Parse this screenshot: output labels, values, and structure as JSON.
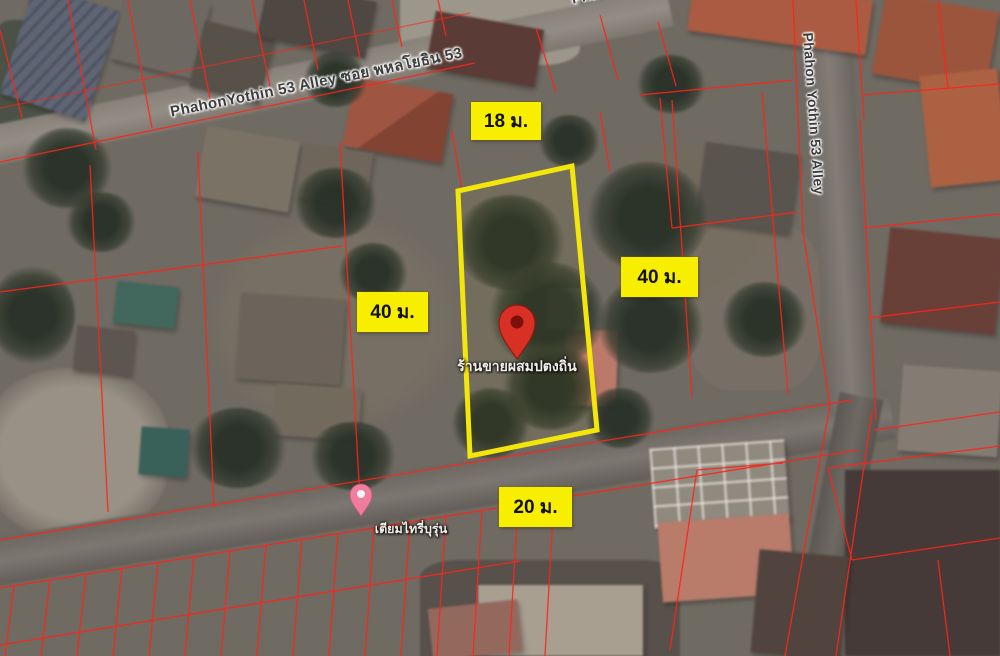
{
  "map": {
    "view": "satellite",
    "roads": {
      "top_alley_label": "PhahonYothin 53 Alley ซอย พหลโยธิน 53",
      "right_alley_label": "Phahon Yothin 53 Alley",
      "top_edge_partial_label": "Phahon"
    },
    "plot": {
      "outline_color": "#f2e60a",
      "dimensions": {
        "top": "18 ม.",
        "left": "40 ม.",
        "right": "40 ม.",
        "bottom": "20 ม."
      }
    },
    "markers": {
      "main_pin": {
        "icon": "red-location-pin",
        "color": "#d93025",
        "label": "ร้านขายผสมปตงถิ่น"
      },
      "poi_pin": {
        "icon": "pink-place-pin",
        "color": "#ee7d9e",
        "label": "เตียมไทรี่บุรุ่น"
      }
    },
    "overlay_colors": {
      "cadastral_line": "#ff2419",
      "dimension_label_bg": "#f8ee00",
      "dimension_label_text": "#111111"
    }
  }
}
